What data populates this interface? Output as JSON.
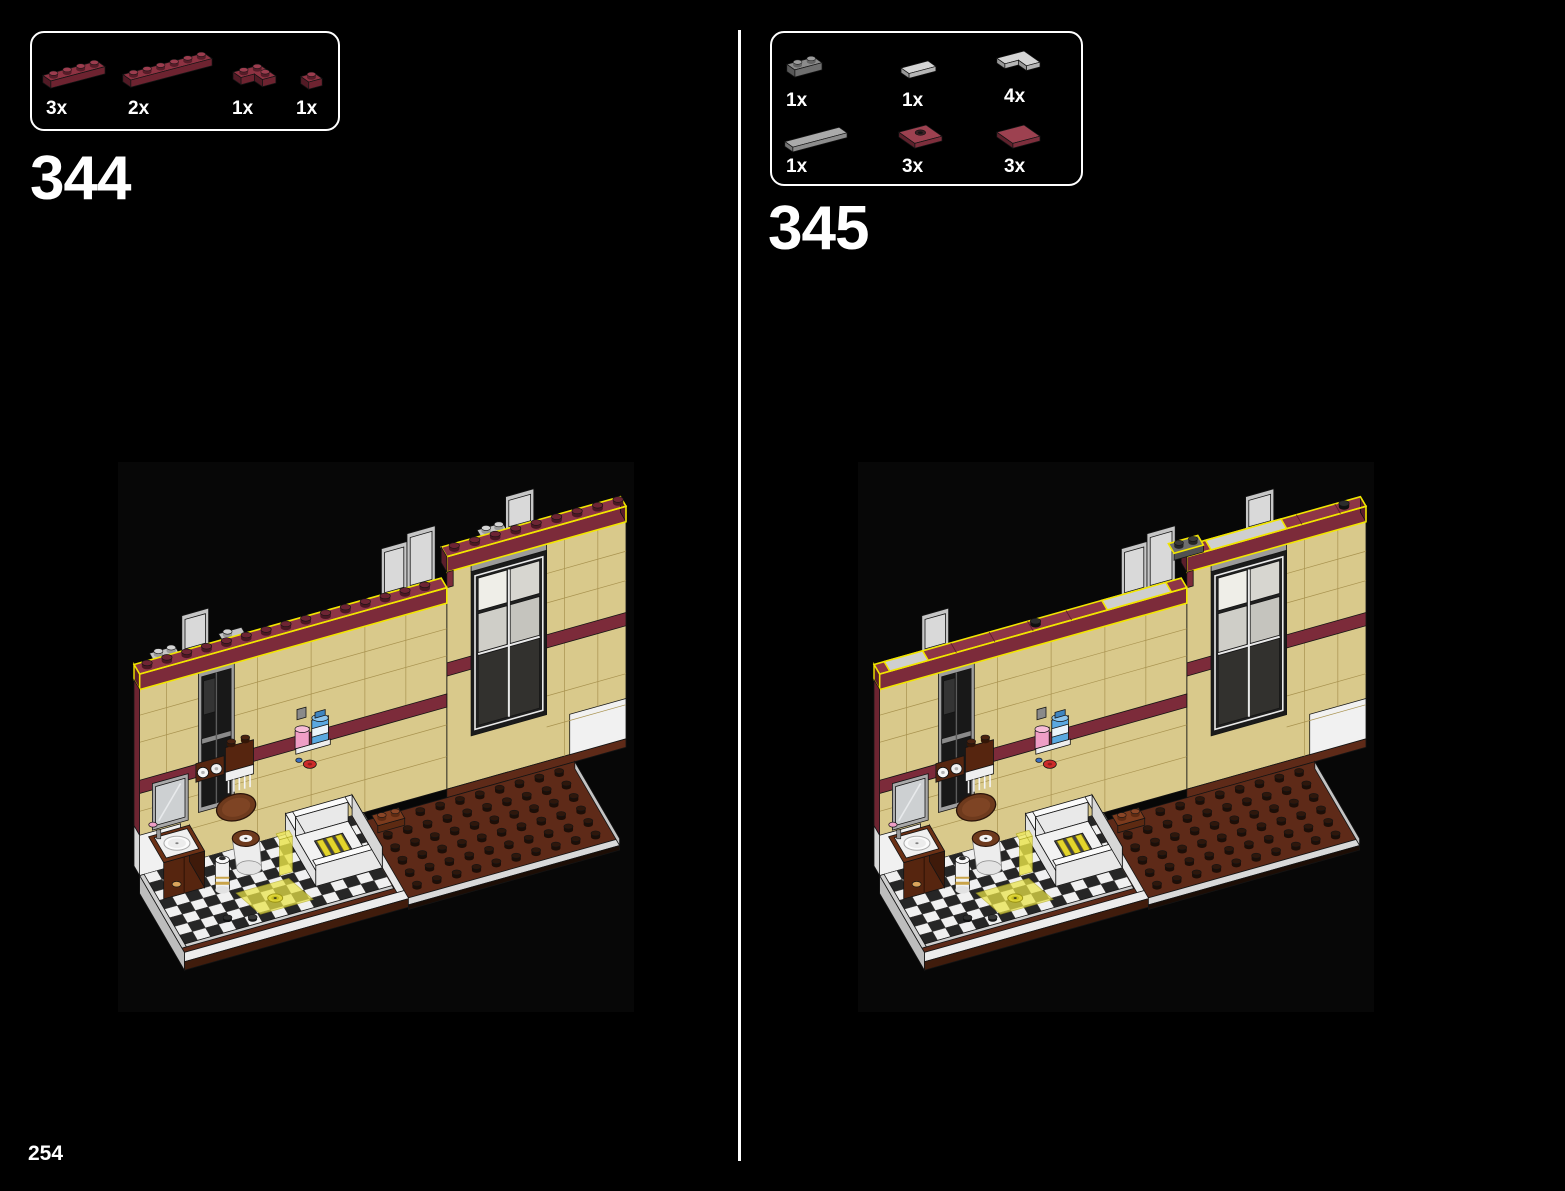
{
  "page": {
    "number": "254"
  },
  "steps": [
    {
      "number": "344",
      "parts": [
        {
          "name": "plate-1x4-dark-red",
          "count": "3x",
          "kind": "plate",
          "w": 4,
          "d": 1,
          "color": "darkred"
        },
        {
          "name": "plate-1x6-dark-red",
          "count": "2x",
          "kind": "plate",
          "w": 6,
          "d": 1,
          "color": "darkred"
        },
        {
          "name": "plate-2x2-corner-dark-red",
          "count": "1x",
          "kind": "cornerPlate",
          "w": 2,
          "d": 2,
          "color": "darkred"
        },
        {
          "name": "plate-1x1-dark-red",
          "count": "1x",
          "kind": "plate",
          "w": 1,
          "d": 1,
          "color": "darkred"
        }
      ]
    },
    {
      "number": "345",
      "parts": [
        {
          "name": "plate-1x2-dark-gray",
          "count": "1x",
          "kind": "plate",
          "w": 2,
          "d": 1,
          "color": "darkgray"
        },
        {
          "name": "tile-1x2-light-gray",
          "count": "1x",
          "kind": "tile",
          "w": 2,
          "d": 1,
          "color": "lightgray"
        },
        {
          "name": "tile-2x2-corner-light-gray",
          "count": "4x",
          "kind": "cornerTile",
          "w": 2,
          "d": 2,
          "color": "lightgray"
        },
        {
          "name": "tile-1x4-light-gray",
          "count": "1x",
          "kind": "tile",
          "w": 4,
          "d": 1,
          "color": "gray"
        },
        {
          "name": "tile-2x2-center-stud-dark-red",
          "count": "3x",
          "kind": "jumper",
          "w": 2,
          "d": 2,
          "color": "red"
        },
        {
          "name": "tile-2x2-dark-red",
          "count": "3x",
          "kind": "tile",
          "w": 2,
          "d": 2,
          "color": "red"
        }
      ]
    }
  ],
  "part_colors": {
    "darkred": {
      "top": "#8e3242",
      "front": "#6d2330",
      "side": "#521a25",
      "studTop": "#9c3c4e",
      "studSide": "#561c28"
    },
    "red": {
      "top": "#9d4150",
      "front": "#7d2e3c",
      "side": "#5f212c",
      "studTop": "#ad4c5c",
      "studSide": "#6a2531"
    },
    "darkgray": {
      "top": "#8c8c8c",
      "front": "#6f6f6f",
      "side": "#585858",
      "studTop": "#9b9b9b",
      "studSide": "#636363"
    },
    "lightgray": {
      "top": "#d4d4d4",
      "front": "#b4b4b4",
      "side": "#989898",
      "studTop": "#e0e0e0",
      "studSide": "#a8a8a8"
    },
    "gray": {
      "top": "#aaaaaa",
      "front": "#8c8c8c",
      "side": "#747474",
      "studTop": "#b8b8b8",
      "studSide": "#8a8a8a"
    }
  },
  "scene_colors": {
    "tan": "#d9c98b",
    "tan_side": "#e7dba8",
    "tan_line": "#a8924f",
    "maroon": "#7c2b3a",
    "maroon_top": "#8e3546",
    "maroon_dark": "#5c1e2b",
    "highlight": "#f2e600",
    "white": "#f1f1f1",
    "gray_rim": "#cfcfcf",
    "gray_panel": "#c6c6c6",
    "gray_frame": "#9f9f9f",
    "window_dark": "#181818",
    "floor_black": "#262626",
    "floor_white": "#f0f0f0",
    "brown_floor": "#5e2a18",
    "brown_dark": "#401c0c",
    "brown_stud": "#2e170c",
    "wood": "#6e3a1d",
    "wood_dark": "#56250f",
    "yellow_trans": "#eae448",
    "pink": "#ef9ec6",
    "blue": "#5aa8e0",
    "red": "#cc2a2a",
    "line": "#141414"
  }
}
